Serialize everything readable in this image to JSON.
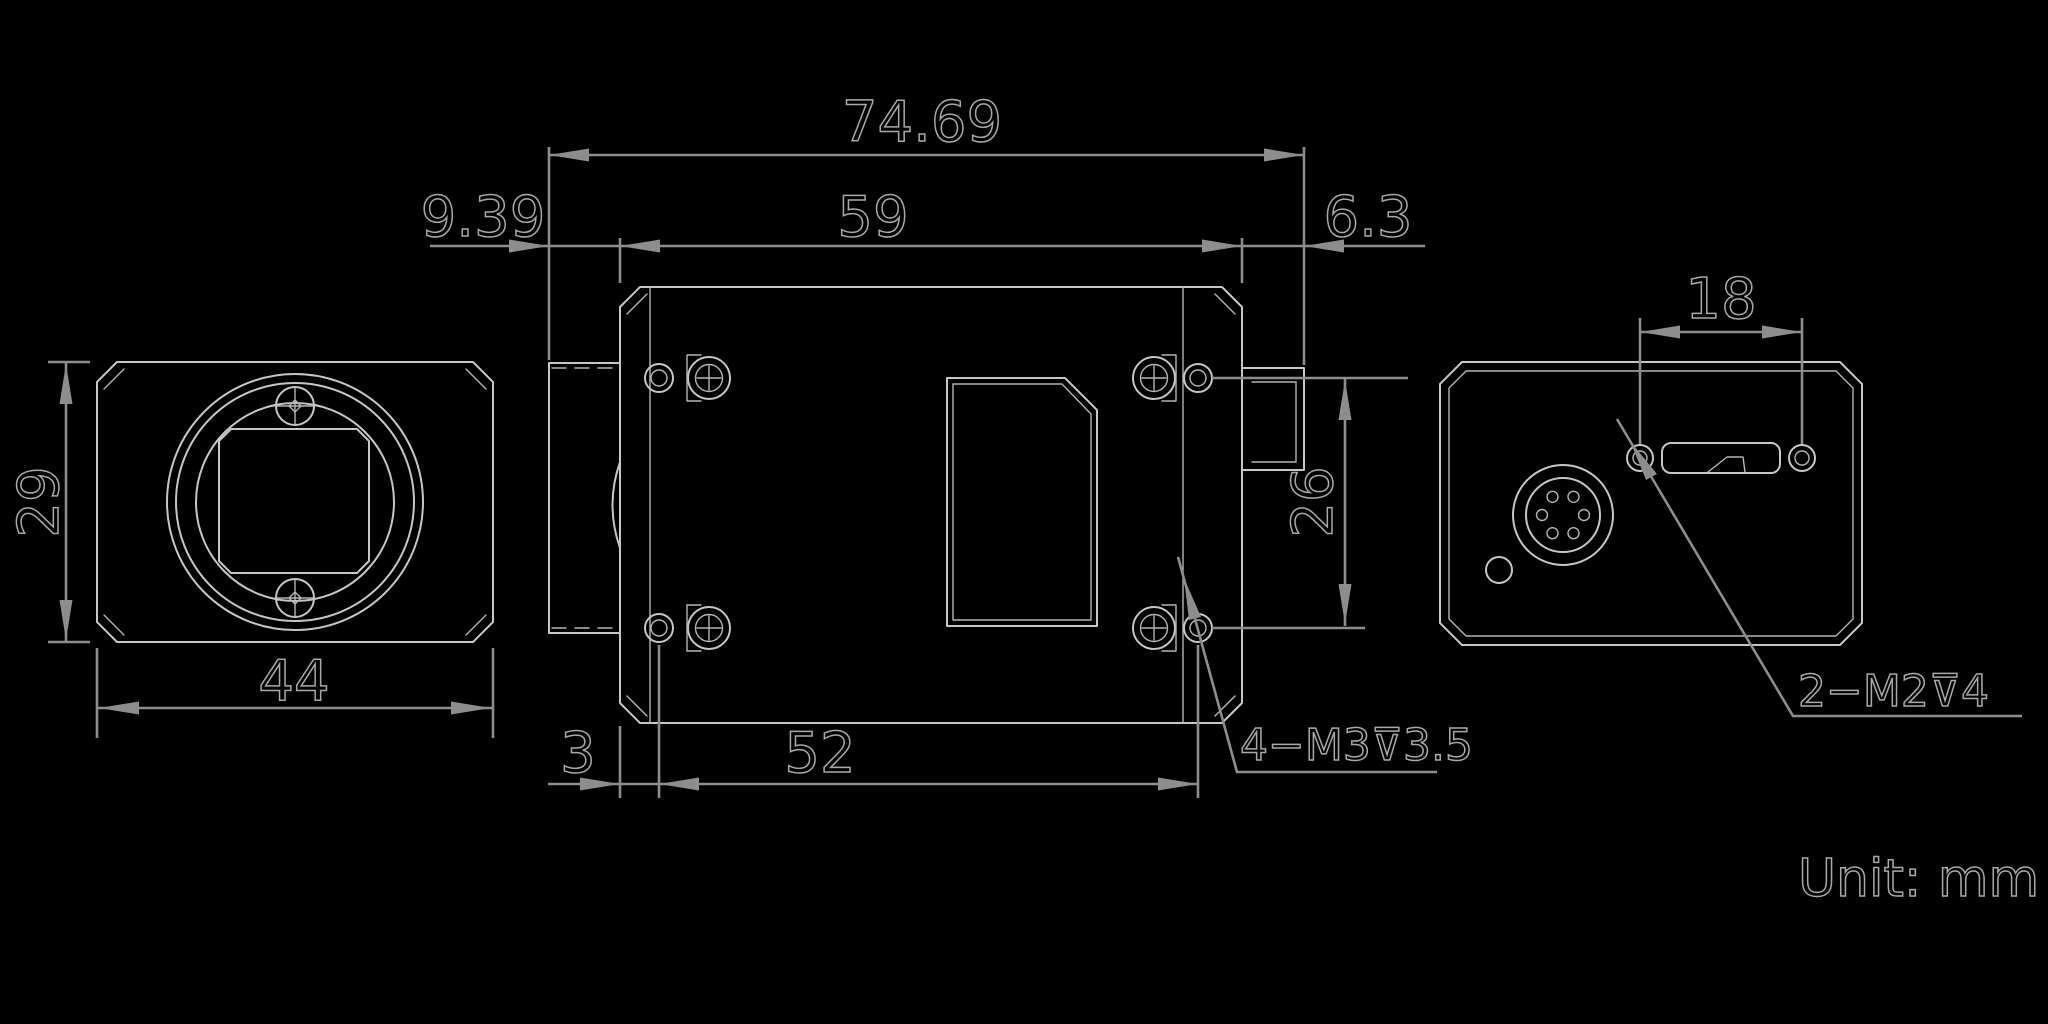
{
  "unit_note": "Unit: mm",
  "colors": {
    "background": "#000000",
    "part_line": "#c6c6c6",
    "dimension_line": "#8d8d8d",
    "text": "#a8a8a8"
  },
  "views": {
    "front": {
      "height_mm": "29",
      "width_mm": "44"
    },
    "top": {
      "overall_length_mm": "74.69",
      "body_length_mm": "59",
      "lens_protrusion_mm": "9.39",
      "rear_protrusion_mm": "6.3",
      "hole_row_spacing_mm": "26",
      "hole_front_offset_mm": "3",
      "hole_column_spacing_mm": "52",
      "thread_label": "4−M3⊽3.5"
    },
    "back": {
      "screw_spacing_mm": "18",
      "thread_label": "2−M2⊽4"
    }
  }
}
